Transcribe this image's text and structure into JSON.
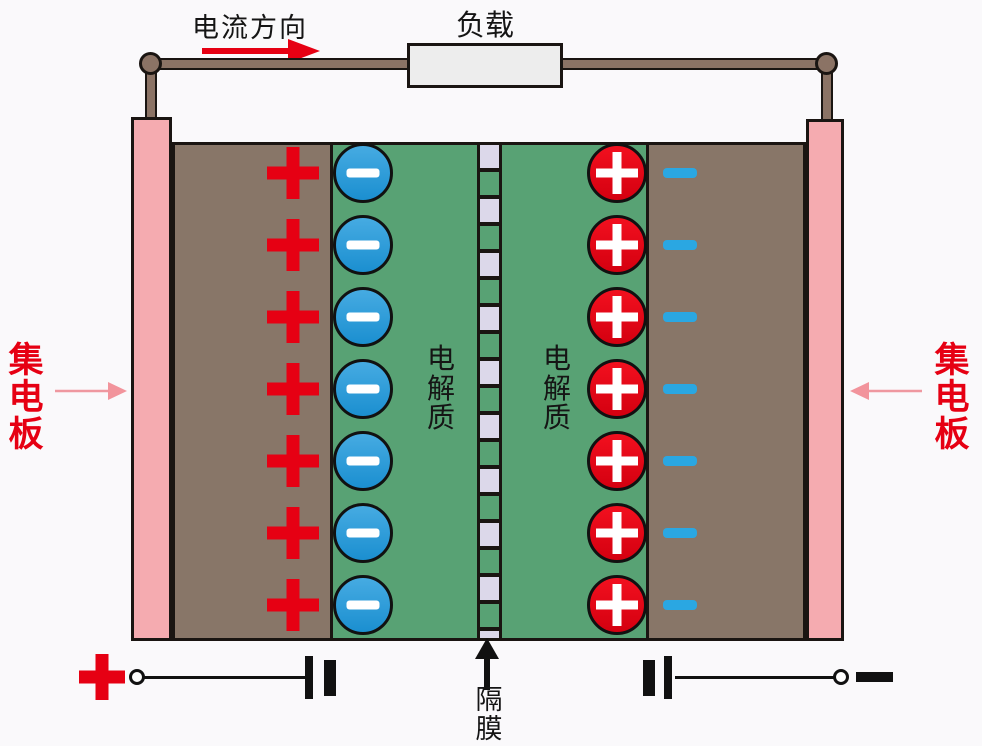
{
  "labels": {
    "current_direction": "电流方向",
    "load": "负载",
    "collector_left": "集电板",
    "collector_right": "集电板",
    "electrolyte_left": "电解质",
    "electrolyte_right": "电解质",
    "separator": "隔膜"
  },
  "ions": {
    "rows": 7,
    "anode_surface_charge_symbol": "+",
    "anode_ion_symbol": "−",
    "cathode_ion_symbol": "+",
    "cathode_surface_charge_symbol": "−"
  },
  "terminals": {
    "positive_symbol": "+",
    "negative_symbol": "−"
  },
  "colors": {
    "collector_pink": "#f5abb0",
    "electrode_brown": "#887668",
    "electrolyte_green": "#58a274",
    "separator_lavender": "#dcd8ea",
    "positive_red": "#e60013",
    "negative_ion_blue": "#2196d8",
    "charge_dash_blue": "#2aa7e2",
    "wire_brown": "#8b7365",
    "load_gray": "#ededed"
  }
}
